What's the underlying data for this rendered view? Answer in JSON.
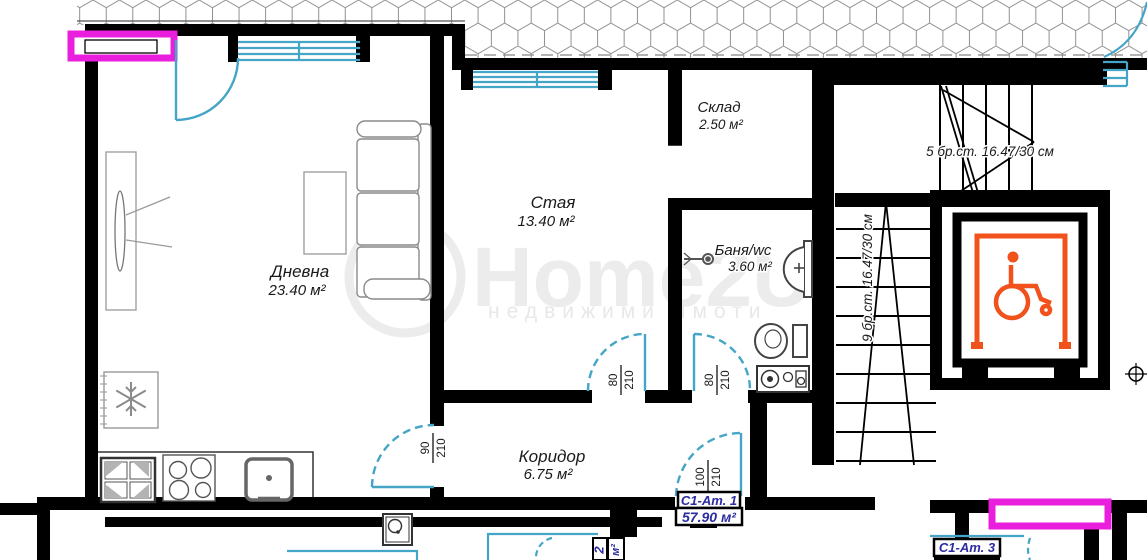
{
  "plan": {
    "rooms": {
      "living": {
        "name": "Дневна",
        "area": "23.40 м²"
      },
      "room": {
        "name": "Стая",
        "area": "13.40 м²"
      },
      "storage": {
        "name": "Склад",
        "area": "2.50 м²"
      },
      "bath": {
        "name": "Баня/wc",
        "area": "3.60 м²"
      },
      "corridor": {
        "name": "Коридор",
        "area": "6.75 м²"
      }
    },
    "doors": {
      "living_door": {
        "num": "90",
        "den": "210"
      },
      "room_door": {
        "num": "80",
        "den": "210"
      },
      "bath_door": {
        "num": "80",
        "den": "210"
      },
      "entry_door": {
        "num": "100",
        "den": "210"
      }
    },
    "stairs": {
      "flight_top": "5 бр.ст. 16.47/30 см",
      "flight_side": "9 бр.ст. 16.47/30 см"
    },
    "units": {
      "unit1_name": "С1-Ат. 1",
      "unit1_area": "57.90 м²",
      "unit2_digit": "2",
      "unit2_sqm": "м²",
      "unit3_name": "С1-Ат. 3"
    },
    "watermark": {
      "brand": "Home2U",
      "tagline": "недвижими имоти"
    },
    "colors": {
      "joinery_cyan": "#45a5c6",
      "window_magenta": "#ea1fdd",
      "elevator_orange": "#f1511b",
      "label_navy": "#2b2ba2",
      "wall_black": "#000000"
    },
    "icons": {
      "elevator": "wheelchair-icon",
      "fridge": "snowflake-icon",
      "bath": [
        "shower-icon",
        "sink-icon",
        "toilet-icon",
        "washing-machine-icon"
      ]
    }
  }
}
